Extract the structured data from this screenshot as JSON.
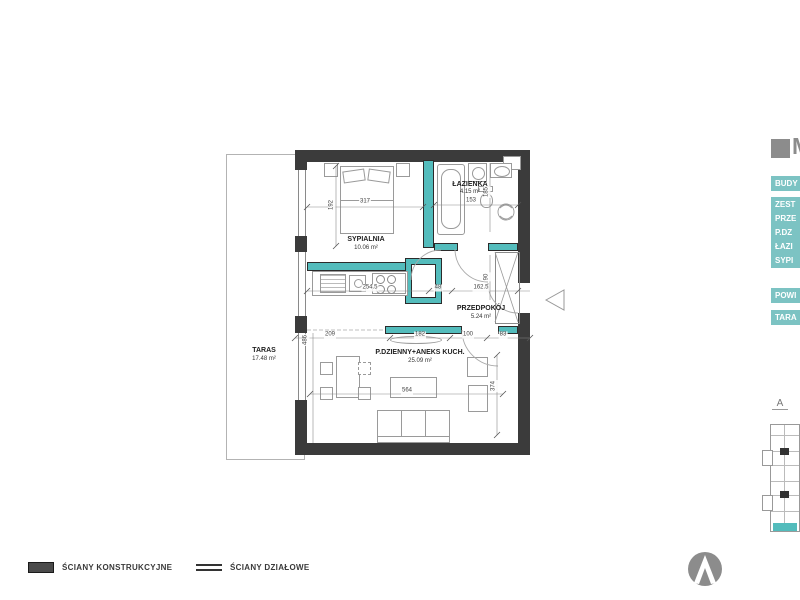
{
  "plan": {
    "rooms": {
      "sypialnia": {
        "name": "SYPIALNIA",
        "area": "10.06 m²"
      },
      "lazienka": {
        "name": "ŁAZIENKA",
        "area": "4.15 m²"
      },
      "przedpokoj": {
        "name": "PRZEDPOKÓJ",
        "area": "5.24 m²"
      },
      "dzienny": {
        "name": "P.DZIENNY+ANEKS KUCH.",
        "area": "25.09 m²"
      },
      "taras": {
        "name": "TARAS",
        "area": "17.48 m²"
      }
    },
    "dims": {
      "bedroom_w": "317",
      "bedroom_h": "192",
      "bath_w": "153",
      "bath_h": "185",
      "shaft_h": "90",
      "kitchen_w": "254.5",
      "door_w": "48",
      "hall_w": "162.5",
      "living_h_left": "486",
      "seg1": "209",
      "seg2": "182",
      "seg3": "100",
      "seg4": "83",
      "living_w": "564",
      "living_h_right": "374"
    }
  },
  "legend": {
    "structural": "ŚCIANY KONSTRUKCYJNE",
    "partition": "ŚCIANY DZIAŁOWE"
  },
  "side_panel": {
    "unit": "M",
    "bar_building": "BUDY",
    "row1": "ZEST",
    "row2": "PRZE",
    "row3": "P.DZ",
    "row4": "ŁAZI",
    "row5": "SYPI",
    "bar_area": "POWI",
    "bar_taras": "TARA"
  },
  "key_plan": {
    "section": "A"
  },
  "colors": {
    "wall": "#3b3b3b",
    "partition_teal": "#53bcbc",
    "panel_teal": "#7cc3c3",
    "gray": "#8c8c8c"
  }
}
